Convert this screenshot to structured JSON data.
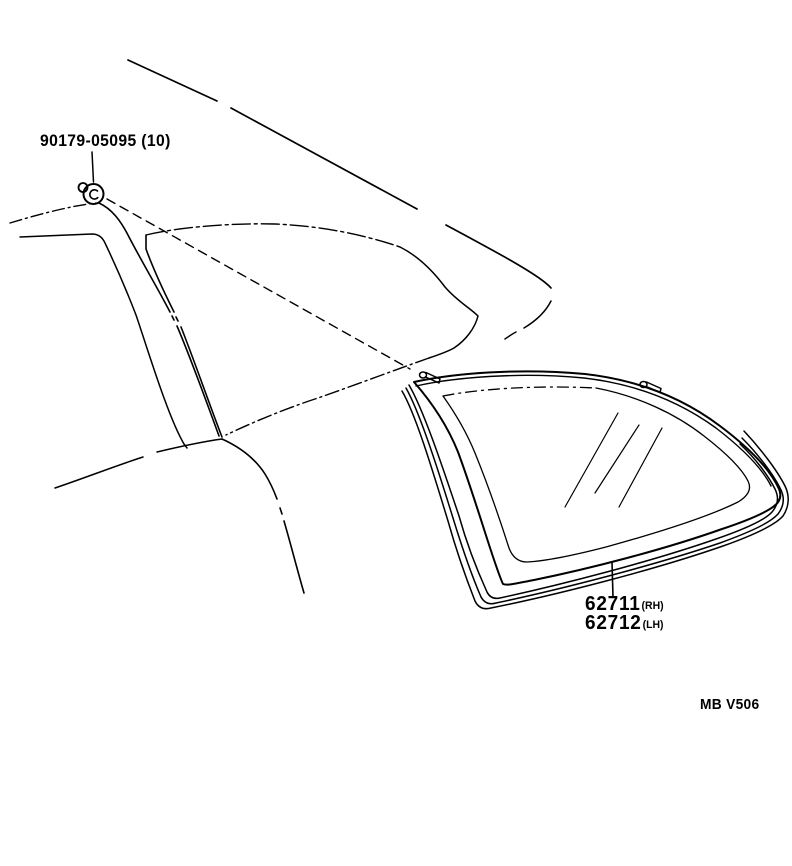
{
  "colors": {
    "ink": "#000000",
    "paper": "#ffffff"
  },
  "labels": {
    "fastener": {
      "text": "90179-05095 (10)"
    },
    "glass_rh": {
      "number": "62711",
      "side": "(RH)"
    },
    "glass_lh": {
      "number": "62712",
      "side": "(LH)"
    },
    "figure_code": "MB V506"
  },
  "icons": {
    "fastener": "grommet-clip-icon",
    "glass_mounts": "retainer-stud-icon"
  },
  "drawing": {
    "subject": "quarter window glass and body side line art",
    "parts_called_out": [
      "90179-05095",
      "62711",
      "62712"
    ],
    "quantity_note": "(10)"
  }
}
